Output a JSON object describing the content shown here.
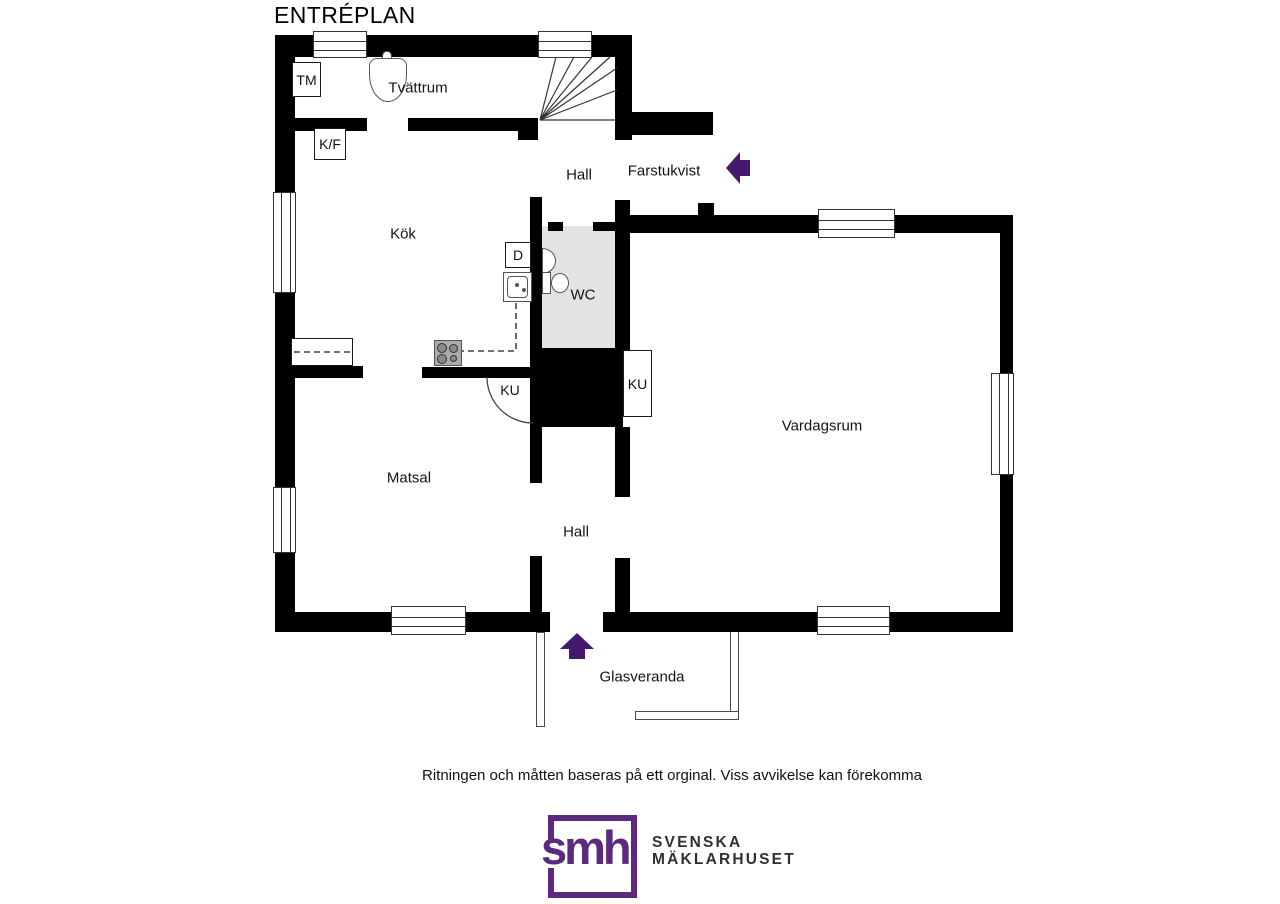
{
  "title": "ENTRÉPLAN",
  "rooms": {
    "tvattrum": "Tvättrum",
    "hall_upper": "Hall",
    "farstukvist": "Farstukvist",
    "kok": "Kök",
    "wc": "WC",
    "vardagsrum": "Vardagsrum",
    "matsal": "Matsal",
    "hall_lower": "Hall",
    "glasveranda": "Glasveranda"
  },
  "fixtures": {
    "tm": "TM",
    "kf": "K/F",
    "d": "D",
    "ku_left": "KU",
    "ku_right": "KU"
  },
  "footer": {
    "disclaimer": "Ritningen och måtten baseras på ett orginal. Viss avvikelse kan förekomma"
  },
  "logo": {
    "monogram": "smh",
    "name_line1": "SVENSKA",
    "name_line2": "MÄKLARHUSET"
  },
  "colors": {
    "wall": "#000000",
    "wc_floor": "#e3e3e3",
    "arrow_purple": "#451a6e",
    "logo_purple": "#5b2a7e",
    "logo_text": "#2f2f38"
  }
}
